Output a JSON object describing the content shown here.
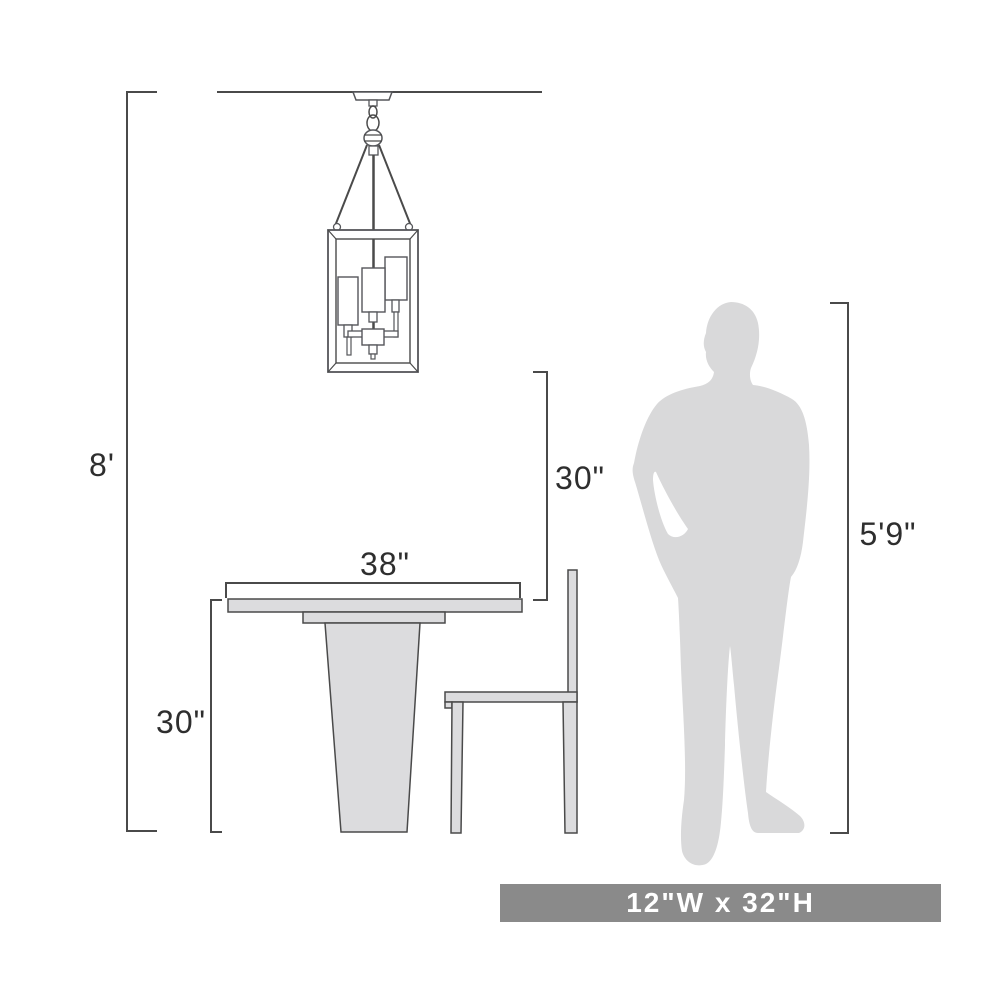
{
  "diagram": {
    "labels": {
      "ceiling_height": "8'",
      "fixture_clearance": "30\"",
      "table_width": "38\"",
      "table_height": "30\"",
      "person_height": "5'9\""
    },
    "banner": {
      "text": "12\"W x 32\"H"
    },
    "colors": {
      "line": "#4a4a4a",
      "furniture_fill": "#dcdcde",
      "silhouette_fill": "#d9d9da",
      "banner_bg": "#8a8a8a",
      "banner_text": "#ffffff"
    },
    "objects": [
      "pendant-light-fixture",
      "ceiling-line",
      "dining-table",
      "dining-chair",
      "person-silhouette"
    ]
  }
}
